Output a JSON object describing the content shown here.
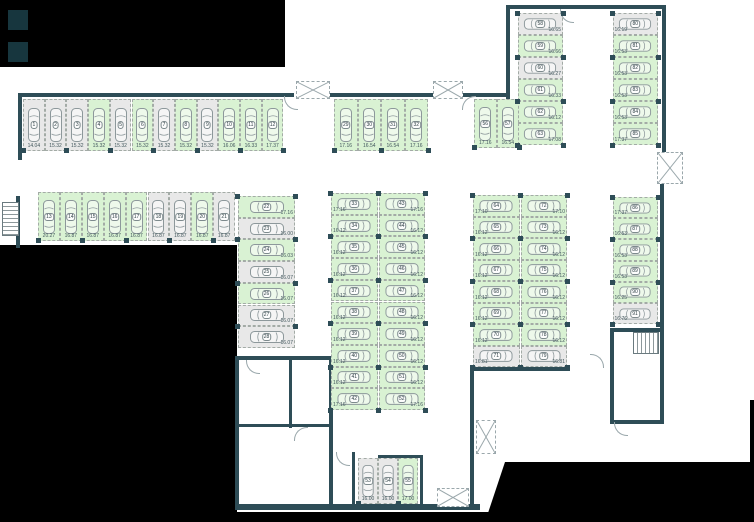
{
  "canvas": {
    "width": 754,
    "height": 522
  },
  "colors": {
    "available_fill": "#d9f2d3",
    "occupied_fill": "#e8e8e8",
    "wall": "#2e4d57",
    "background": "#ffffff",
    "mask": "#000000",
    "dashed_outline": "#a3aba6"
  },
  "floorplan": {
    "groups": [
      {
        "name": "top-left-row",
        "dir": "v",
        "x": 23,
        "y": 99,
        "cw": 21.7,
        "ch": 52,
        "label": "b",
        "spaces": [
          {
            "n": "1",
            "area": "14.04",
            "free": false
          },
          {
            "n": "2",
            "area": "15.32",
            "free": false
          },
          {
            "n": "3",
            "area": "15.32",
            "free": false
          },
          {
            "n": "4",
            "area": "15.32",
            "free": true
          },
          {
            "n": "5",
            "area": "15.32",
            "free": false
          },
          {
            "n": "6",
            "area": "15.32",
            "free": true
          },
          {
            "n": "7",
            "area": "15.32",
            "free": false
          },
          {
            "n": "8",
            "area": "15.32",
            "free": true
          },
          {
            "n": "9",
            "area": "15.32",
            "free": false
          },
          {
            "n": "10",
            "area": "16.06",
            "free": true
          },
          {
            "n": "11",
            "area": "16.33",
            "free": true
          },
          {
            "n": "12",
            "area": "17.37",
            "free": true
          }
        ]
      },
      {
        "name": "top-middle-row",
        "dir": "v",
        "x": 334,
        "y": 99,
        "cw": 23.5,
        "ch": 52,
        "label": "b",
        "spaces": [
          {
            "n": "29",
            "area": "17.16",
            "free": true
          },
          {
            "n": "30",
            "area": "16.54",
            "free": true
          },
          {
            "n": "31",
            "area": "16.54",
            "free": true
          },
          {
            "n": "32",
            "area": "17.16",
            "free": true
          }
        ]
      },
      {
        "name": "row-56-57",
        "dir": "v",
        "x": 474,
        "y": 99,
        "cw": 22.5,
        "ch": 49,
        "label": "b",
        "spaces": [
          {
            "n": "56",
            "area": "17.16",
            "free": true
          },
          {
            "n": "57",
            "area": "16.54",
            "free": true
          }
        ]
      },
      {
        "name": "second-left-row",
        "dir": "v",
        "x": 38,
        "y": 192,
        "cw": 21.9,
        "ch": 49,
        "label": "b",
        "spaces": [
          {
            "n": "13",
            "area": "20.27",
            "free": true
          },
          {
            "n": "14",
            "area": "16.87",
            "free": true
          },
          {
            "n": "15",
            "area": "16.87",
            "free": true
          },
          {
            "n": "16",
            "area": "16.87",
            "free": true
          },
          {
            "n": "17",
            "area": "16.87",
            "free": true
          },
          {
            "n": "18",
            "area": "16.87",
            "free": false
          },
          {
            "n": "19",
            "area": "16.87",
            "free": false
          },
          {
            "n": "20",
            "area": "16.87",
            "free": true
          },
          {
            "n": "21",
            "area": "16.87",
            "free": false
          }
        ]
      },
      {
        "name": "left-column",
        "dir": "h",
        "x": 238,
        "y": 196,
        "cw": 57,
        "ch": 21.7,
        "label": "br",
        "spaces": [
          {
            "n": "22",
            "area": "17.16",
            "free": true
          },
          {
            "n": "23",
            "area": "16.00",
            "free": false
          },
          {
            "n": "24",
            "area": "16.03",
            "free": true
          },
          {
            "n": "25",
            "area": "16.07",
            "free": false
          },
          {
            "n": "26",
            "area": "16.07",
            "free": true
          },
          {
            "n": "27",
            "area": "16.07",
            "free": false
          },
          {
            "n": "28",
            "area": "16.07",
            "free": false
          }
        ]
      },
      {
        "name": "center-column-left",
        "dir": "h",
        "x": 331,
        "y": 193,
        "cw": 46.5,
        "ch": 21.7,
        "label": "bl",
        "spaces": [
          {
            "n": "33",
            "area": "17.16",
            "free": true
          },
          {
            "n": "34",
            "area": "16.12",
            "free": true
          },
          {
            "n": "35",
            "area": "16.12",
            "free": true
          },
          {
            "n": "36",
            "area": "16.12",
            "free": true
          },
          {
            "n": "37",
            "area": "16.12",
            "free": true
          },
          {
            "n": "38",
            "area": "16.12",
            "free": true
          },
          {
            "n": "39",
            "area": "16.12",
            "free": true
          },
          {
            "n": "40",
            "area": "16.12",
            "free": true
          },
          {
            "n": "41",
            "area": "16.12",
            "free": true
          },
          {
            "n": "42",
            "area": "17.16",
            "free": true
          }
        ]
      },
      {
        "name": "center-column-right",
        "dir": "h",
        "x": 378.5,
        "y": 193,
        "cw": 46.5,
        "ch": 21.7,
        "label": "br",
        "spaces": [
          {
            "n": "43",
            "area": "17.16",
            "free": true
          },
          {
            "n": "44",
            "area": "16.12",
            "free": true
          },
          {
            "n": "45",
            "area": "16.12",
            "free": true
          },
          {
            "n": "46",
            "area": "16.12",
            "free": true
          },
          {
            "n": "47",
            "area": "16.12",
            "free": true
          },
          {
            "n": "48",
            "area": "16.12",
            "free": true
          },
          {
            "n": "49",
            "area": "16.12",
            "free": true
          },
          {
            "n": "50",
            "area": "16.12",
            "free": true
          },
          {
            "n": "51",
            "area": "16.12",
            "free": true
          },
          {
            "n": "52",
            "area": "17.16",
            "free": true
          }
        ]
      },
      {
        "name": "mid-right-column-left",
        "dir": "h",
        "x": 473,
        "y": 195,
        "cw": 46.5,
        "ch": 21.5,
        "label": "bl",
        "spaces": [
          {
            "n": "64",
            "area": "17.10",
            "free": true
          },
          {
            "n": "65",
            "area": "16.12",
            "free": true
          },
          {
            "n": "66",
            "area": "16.12",
            "free": true
          },
          {
            "n": "67",
            "area": "16.12",
            "free": true
          },
          {
            "n": "68",
            "area": "16.12",
            "free": true
          },
          {
            "n": "69",
            "area": "16.12",
            "free": true
          },
          {
            "n": "70",
            "area": "16.12",
            "free": true
          },
          {
            "n": "71",
            "area": "16.81",
            "free": false
          }
        ]
      },
      {
        "name": "mid-right-column-right",
        "dir": "h",
        "x": 520.5,
        "y": 195,
        "cw": 46.5,
        "ch": 21.5,
        "label": "br",
        "spaces": [
          {
            "n": "72",
            "area": "17.10",
            "free": true
          },
          {
            "n": "73",
            "area": "16.12",
            "free": true
          },
          {
            "n": "74",
            "area": "16.12",
            "free": true
          },
          {
            "n": "75",
            "area": "16.12",
            "free": true
          },
          {
            "n": "76",
            "area": "16.12",
            "free": true
          },
          {
            "n": "77",
            "area": "16.12",
            "free": true
          },
          {
            "n": "78",
            "area": "16.12",
            "free": true
          },
          {
            "n": "79",
            "area": "16.81",
            "free": false
          }
        ]
      },
      {
        "name": "far-right-column",
        "dir": "h",
        "x": 612.5,
        "y": 197,
        "cw": 45,
        "ch": 21.2,
        "label": "bl",
        "spaces": [
          {
            "n": "86",
            "area": "17.37",
            "free": true
          },
          {
            "n": "87",
            "area": "16.53",
            "free": true
          },
          {
            "n": "88",
            "area": "16.53",
            "free": true
          },
          {
            "n": "89",
            "area": "16.53",
            "free": true
          },
          {
            "n": "90",
            "area": "16.25",
            "free": true
          },
          {
            "n": "91",
            "area": "16.76",
            "free": false
          }
        ]
      },
      {
        "name": "top-right-column-left",
        "dir": "h",
        "x": 517.5,
        "y": 13,
        "cw": 45.5,
        "ch": 22,
        "label": "br",
        "spaces": [
          {
            "n": "58",
            "area": "16.65",
            "free": false
          },
          {
            "n": "59",
            "area": "16.66",
            "free": true
          },
          {
            "n": "60",
            "area": "16.27",
            "free": false
          },
          {
            "n": "61",
            "area": "16.33",
            "free": true
          },
          {
            "n": "62",
            "area": "16.12",
            "free": true
          },
          {
            "n": "63",
            "area": "17.08",
            "free": true
          }
        ]
      },
      {
        "name": "top-right-column-right",
        "dir": "h",
        "x": 612.5,
        "y": 13,
        "cw": 45.5,
        "ch": 22,
        "label": "bl",
        "spaces": [
          {
            "n": "80",
            "area": "16.19",
            "free": false
          },
          {
            "n": "81",
            "area": "16.53",
            "free": true
          },
          {
            "n": "82",
            "area": "16.53",
            "free": true
          },
          {
            "n": "83",
            "area": "16.53",
            "free": true
          },
          {
            "n": "84",
            "area": "16.53",
            "free": true
          },
          {
            "n": "85",
            "area": "17.37",
            "free": true
          }
        ]
      },
      {
        "name": "bottom-trio",
        "dir": "v",
        "x": 358,
        "y": 458,
        "cw": 20,
        "ch": 46,
        "label": "b",
        "spaces": [
          {
            "n": "53",
            "area": "16.00",
            "free": false
          },
          {
            "n": "54",
            "area": "16.00",
            "free": false
          },
          {
            "n": "55",
            "area": "17.00",
            "free": true
          }
        ]
      }
    ]
  }
}
